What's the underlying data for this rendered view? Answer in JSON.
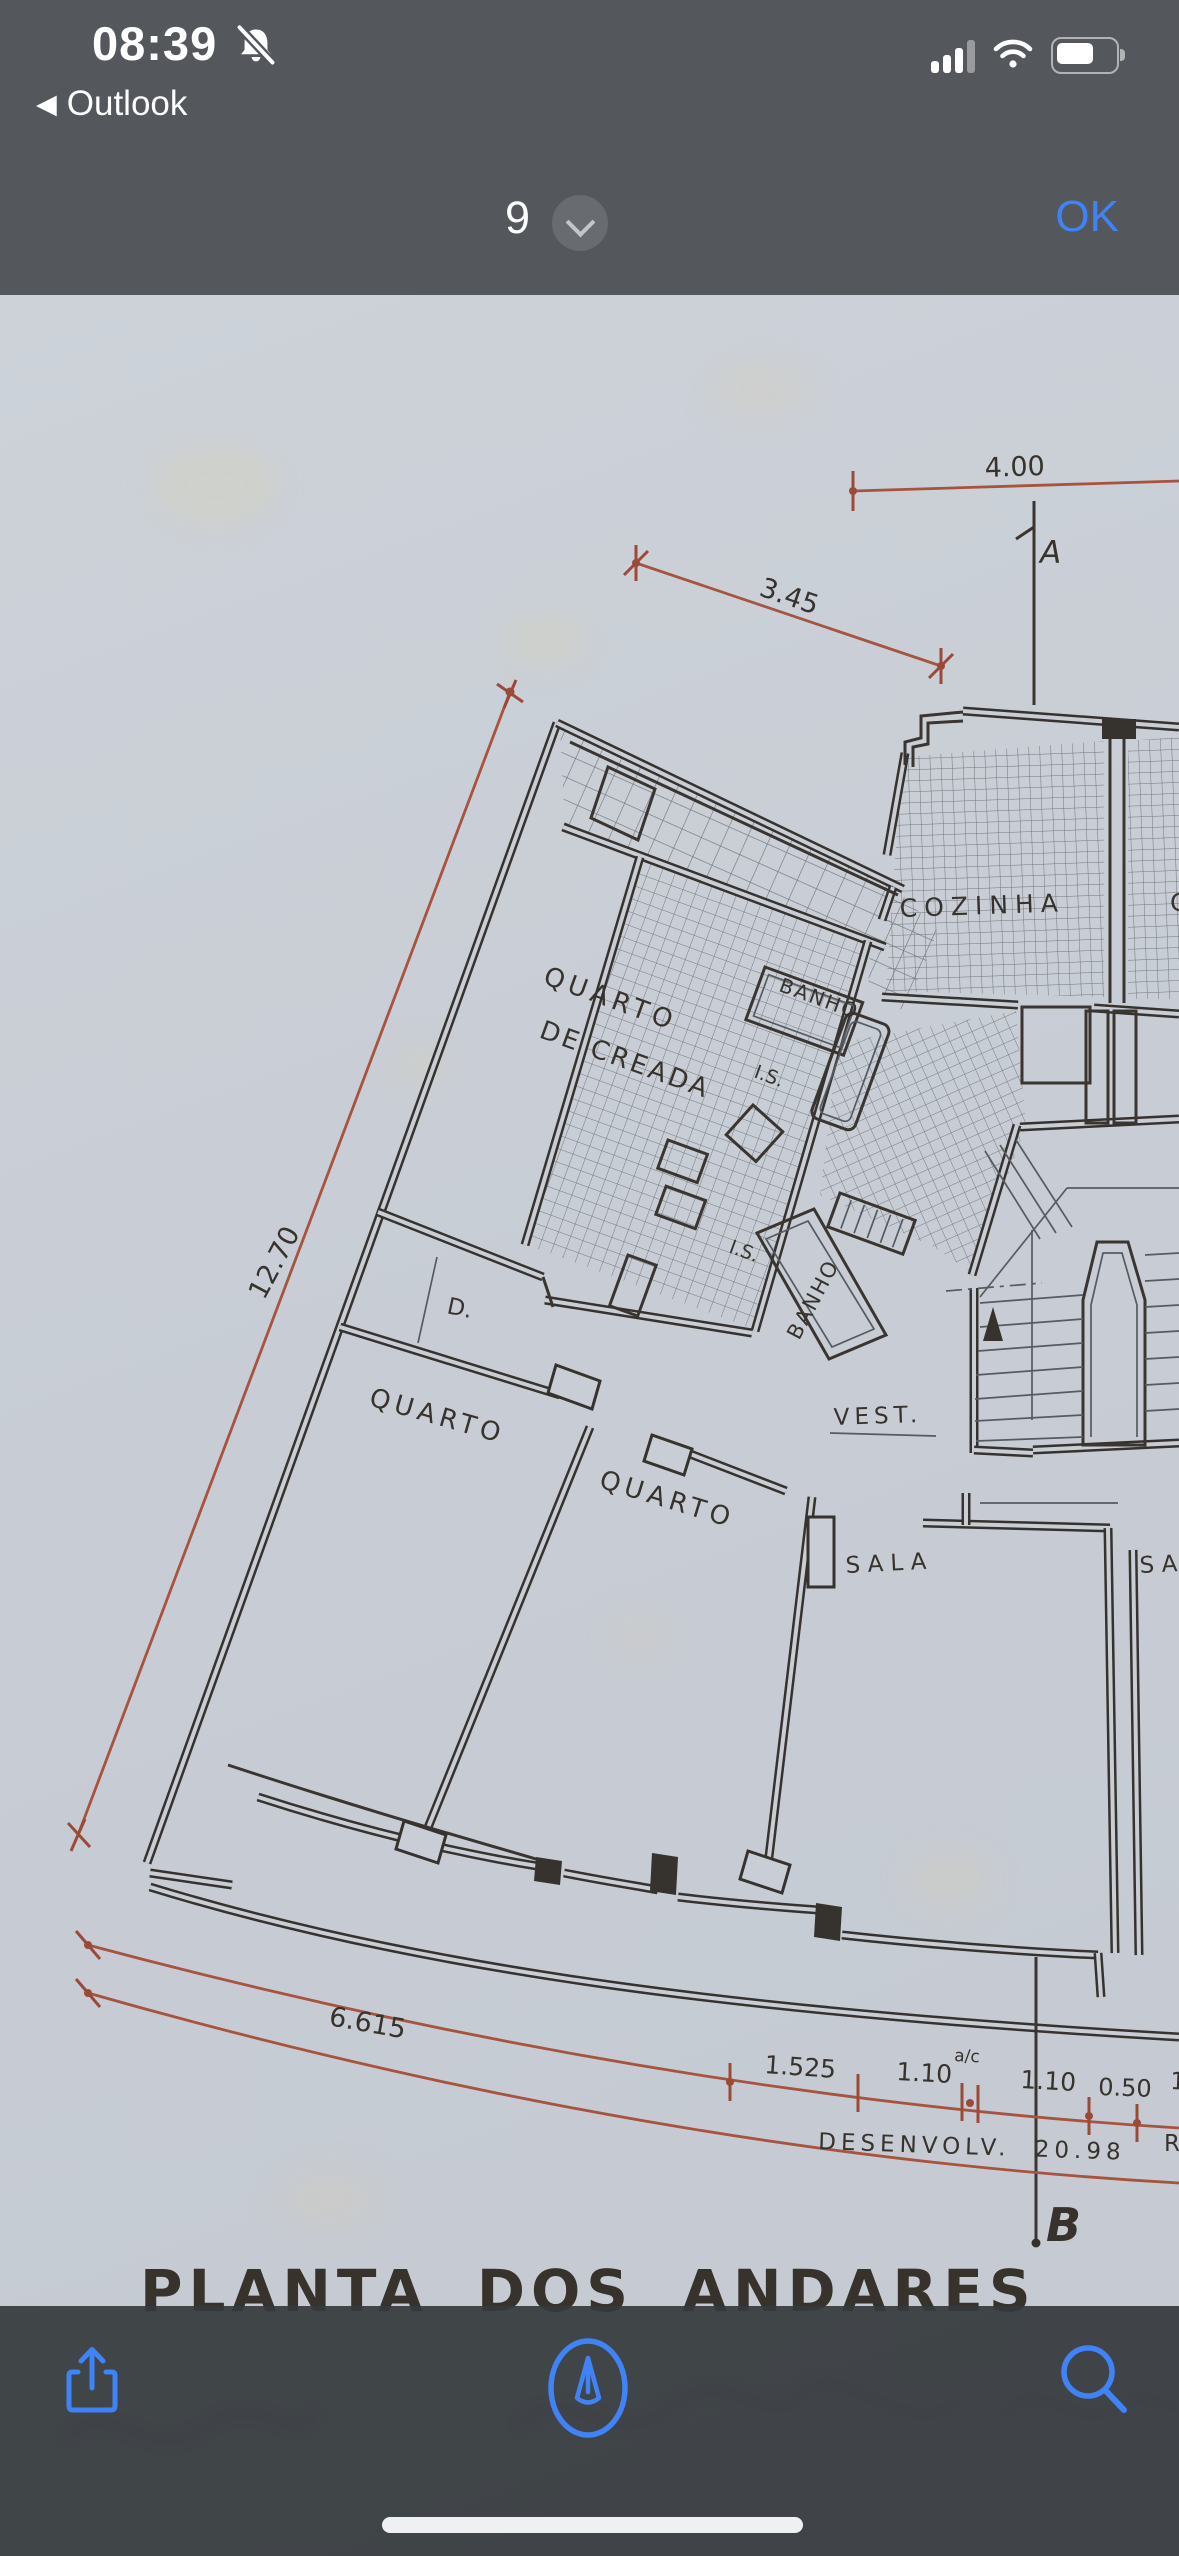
{
  "status_bar": {
    "time": "08:39",
    "back_label": "Outlook",
    "icons": {
      "notifications": "bell-slash-icon",
      "signal": "cellular-signal-icon",
      "wifi": "wifi-icon",
      "battery": "battery-icon"
    }
  },
  "header": {
    "page_indicator": "9",
    "confirm_label": "OK"
  },
  "document": {
    "type": "scanned architectural floor plan",
    "title_words": [
      "PLANTA",
      "DOS",
      "ANDARES"
    ],
    "rooms": {
      "maid_room_line1": "QUARTO",
      "maid_room_line2": "DE CREADA",
      "bath_upper": "BANHO",
      "bath_lower": "BANHO",
      "kitchen": "COZINHA",
      "kitchen_partial": "C",
      "closet": "D.",
      "bedroom_left": "QUARTO",
      "bedroom_middle": "QUARTO",
      "vestibule": "VEST.",
      "living_room": "SALA",
      "living_room_partial": "SA",
      "is_upper": "I.S.",
      "is_lower": "I.S."
    },
    "dimensions": {
      "top": "4.00",
      "diagonal": "3.45",
      "left_side": "12.70",
      "arc": "6.615",
      "seg1": "1.525",
      "seg2": "1.10",
      "seg2_note": "a/c",
      "seg3": "1.10",
      "seg4": "0.50",
      "seg_partial": "1",
      "developed": "DESENVOLV. 20.98",
      "developed_partial": "R"
    },
    "section_markers": {
      "top": "A",
      "bottom": "B"
    },
    "colors": {
      "ink": "#37322c",
      "red_dimension": "#a85340",
      "paper": "#c9ced6"
    }
  },
  "toolbar": {
    "icons": [
      "share-icon",
      "markup-icon",
      "search-icon"
    ]
  }
}
